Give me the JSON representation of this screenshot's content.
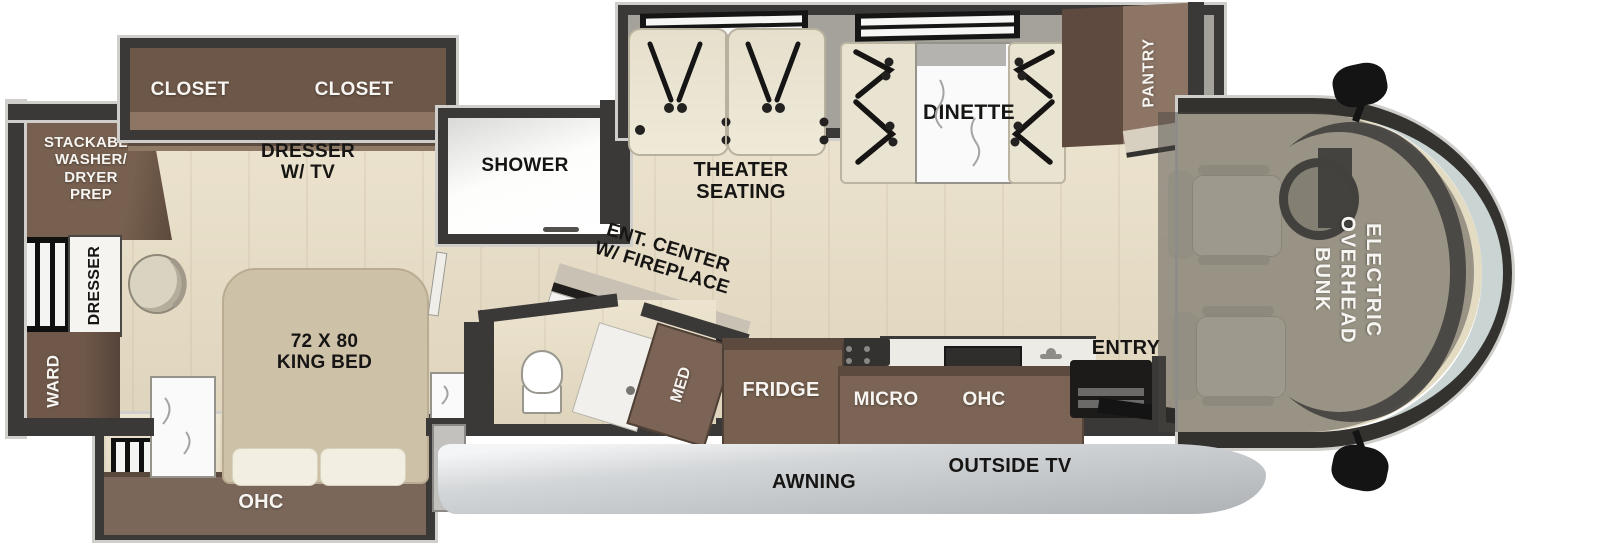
{
  "colors": {
    "wall": "#3b3937",
    "wall_trim": "#cfcecb",
    "floor_wood": "#e8ddc4",
    "cabinet_brown": "#6f5849",
    "cabinet_brown_dark": "#5b4a3d",
    "cabinet_brown_light": "#8d7566",
    "upholstery_cream": "#e9e3d1",
    "marble_white": "#fbfafa",
    "windshield_glass": "#c9d4d3",
    "awning_gray": "#c6cacd",
    "bunk_shade": "rgba(72,68,64,0.48)",
    "label_black": "#161514",
    "label_white": "#f7f5f2"
  },
  "rooms": {
    "bedroom": {
      "closet_left": "CLOSET",
      "closet_right": "CLOSET",
      "dresser_tv": "DRESSER\nW/ TV",
      "washer_dryer": "STACKABLE\nWASHER/\nDRYER\nPREP",
      "dresser": "DRESSER",
      "wardrobe": "WARD",
      "king_bed": "72 X 80\nKING BED",
      "overhead_cabinet": "OHC"
    },
    "bathroom": {
      "shower": "SHOWER",
      "medicine_cabinet": "MED"
    },
    "living_area": {
      "entertainment_center": "ENT. CENTER\nW/ FIREPLACE",
      "theater_seating": "THEATER\nSEATING",
      "dinette": "DINETTE",
      "pantry": "PANTRY"
    },
    "kitchen": {
      "fridge": "FRIDGE",
      "microwave": "MICRO",
      "overhead_cabinet": "OHC",
      "entry": "ENTRY"
    },
    "cab": {
      "overhead_bunk": "ELECTRIC\nOVERHEAD\nBUNK"
    },
    "exterior": {
      "awning": "AWNING",
      "outside_tv": "OUTSIDE TV"
    }
  }
}
